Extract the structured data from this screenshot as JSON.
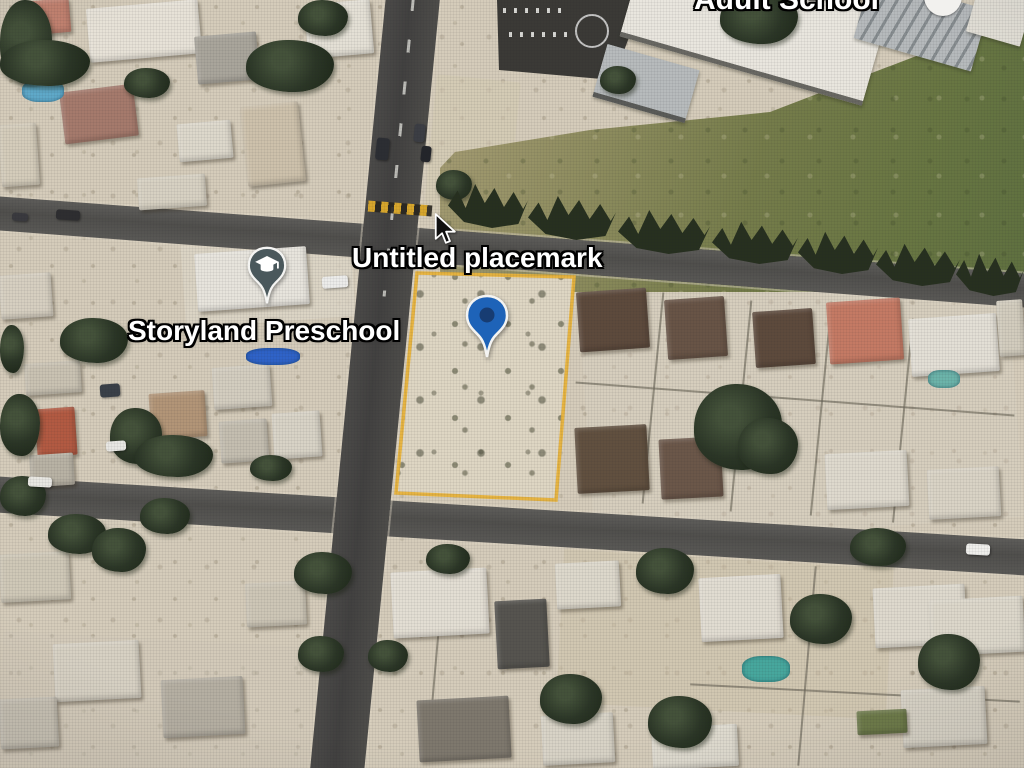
{
  "view": {
    "type": "satellite-aerial-map",
    "description": "Aerial imagery of a desert residential neighborhood with a highlighted vacant parcel"
  },
  "labels": {
    "placemark": "Untitled placemark",
    "preschool": "Storyland Preschool",
    "adult_school": "Adult School"
  },
  "markers": {
    "placemark_pin": {
      "icon": "map-pin",
      "x": 487,
      "y": 320
    },
    "preschool_pin": {
      "icon": "graduation-cap-pin",
      "x": 267,
      "y": 270
    },
    "adult_school_icon": {
      "icon": "white-circle",
      "x": 941,
      "y": 0
    }
  },
  "cursor": {
    "icon": "arrow-cursor",
    "x": 436,
    "y": 217
  },
  "parcel": {
    "points": "417,273 574,277 556,500 396,493",
    "outline_color": "#e7b23b"
  },
  "colors": {
    "pin_blue": "#1e63b8",
    "pin_blue_inner": "#173a6e",
    "pin_school": "#4a585c",
    "pin_outline": "#f4f4f2",
    "poi_circle": "#f2f1ee",
    "road": "#4c4b49",
    "sand": "#d5ccba",
    "grass": "#75804c",
    "tree": "#27301f",
    "crosswalk_yellow": "#d7a62c"
  },
  "scenery": {
    "zones": [
      [
        560,
        556,
        330,
        155,
        3,
        "#cdc1a7",
        0.5
      ],
      [
        183,
        238,
        170,
        84,
        -4,
        "#dcd5c5",
        0.85
      ],
      [
        430,
        78,
        84,
        142,
        5.6,
        "#d3c9b3",
        0.6
      ],
      [
        0,
        640,
        340,
        130,
        3,
        "#cfc8b8",
        0.4
      ],
      [
        586,
        282,
        430,
        250,
        -4,
        "#d9d2c2",
        0.35
      ]
    ],
    "buildings": [
      [
        628,
        -24,
        252,
        92,
        16,
        "#e9e6de",
        "edge"
      ],
      [
        598,
        56,
        96,
        50,
        16,
        "#b7bbbc",
        "edge"
      ],
      [
        860,
        -8,
        122,
        64,
        16,
        "",
        "stripes"
      ],
      [
        972,
        -12,
        56,
        52,
        16,
        "#e2dfd6",
        "plain"
      ]
    ],
    "houses": [
      [
        88,
        4,
        112,
        54,
        -5,
        "#e7e2d7"
      ],
      [
        20,
        0,
        50,
        34,
        -5,
        "#c28270"
      ],
      [
        62,
        88,
        74,
        52,
        -7,
        "#a57a6c"
      ],
      [
        196,
        34,
        62,
        48,
        -5,
        "#a9a59b"
      ],
      [
        306,
        2,
        66,
        54,
        -5,
        "#e4e0d5"
      ],
      [
        178,
        122,
        54,
        38,
        -5,
        "#ddd8cb"
      ],
      [
        244,
        104,
        58,
        80,
        -6,
        "#cdc1ab"
      ],
      [
        0,
        124,
        38,
        62,
        -4,
        "#d4ccba"
      ],
      [
        138,
        176,
        68,
        32,
        -4,
        "#d7d1c2"
      ],
      [
        196,
        250,
        112,
        58,
        -4,
        "#e7e4dc"
      ],
      [
        0,
        274,
        52,
        44,
        -4,
        "#d6cfc0"
      ],
      [
        25,
        362,
        56,
        32,
        -4,
        "#c9c2b2"
      ],
      [
        36,
        408,
        40,
        48,
        -4,
        "#b25a42"
      ],
      [
        150,
        392,
        56,
        46,
        -4,
        "#b29577"
      ],
      [
        213,
        366,
        58,
        42,
        -4,
        "#d3cdbf"
      ],
      [
        220,
        420,
        48,
        42,
        -4,
        "#c4beb0"
      ],
      [
        273,
        412,
        48,
        46,
        -4,
        "#d8d3c6"
      ],
      [
        30,
        454,
        44,
        32,
        -4,
        "#b8b2a4"
      ],
      [
        578,
        290,
        70,
        60,
        -4,
        "#5d4a3c"
      ],
      [
        666,
        298,
        60,
        60,
        -4,
        "#685446"
      ],
      [
        754,
        310,
        60,
        56,
        -4,
        "#5d4a3c"
      ],
      [
        828,
        300,
        74,
        62,
        -4,
        "#c47a64"
      ],
      [
        910,
        316,
        88,
        58,
        -4,
        "#e3dfd5"
      ],
      [
        576,
        426,
        72,
        66,
        -3,
        "#61503f"
      ],
      [
        660,
        438,
        62,
        60,
        -3,
        "#6b5749"
      ],
      [
        826,
        452,
        82,
        56,
        -3,
        "#ded9cd"
      ],
      [
        928,
        468,
        72,
        50,
        -3,
        "#d9d3c5"
      ],
      [
        998,
        300,
        26,
        56,
        -4,
        "#d2ccbd"
      ],
      [
        392,
        570,
        96,
        66,
        -3,
        "#e3ded3"
      ],
      [
        496,
        600,
        52,
        68,
        -3,
        "#56544f"
      ],
      [
        556,
        562,
        64,
        46,
        -3,
        "#ddd8cb"
      ],
      [
        700,
        576,
        82,
        64,
        -3,
        "#e1dcd1"
      ],
      [
        874,
        586,
        92,
        60,
        -3,
        "#ded9cd"
      ],
      [
        418,
        698,
        92,
        62,
        -3,
        "#7e786d"
      ],
      [
        542,
        714,
        72,
        50,
        -3,
        "#d8d3c6"
      ],
      [
        652,
        726,
        86,
        42,
        -3,
        "#dedace"
      ],
      [
        902,
        688,
        84,
        58,
        -3,
        "#d6d1c4"
      ],
      [
        0,
        553,
        70,
        48,
        -3,
        "#cfc8b7"
      ],
      [
        54,
        642,
        86,
        58,
        -3,
        "#d7d1c3"
      ],
      [
        162,
        678,
        82,
        58,
        -3,
        "#b5afa2"
      ],
      [
        246,
        582,
        60,
        44,
        -3,
        "#cdc6b6"
      ],
      [
        0,
        698,
        58,
        50,
        -3,
        "#c7c1b3"
      ],
      [
        930,
        598,
        94,
        56,
        -3,
        "#dcd7ca"
      ],
      [
        857,
        710,
        50,
        24,
        -3,
        "#6d7a49"
      ]
    ],
    "trees": [
      [
        0,
        0,
        52,
        84
      ],
      [
        246,
        40,
        88,
        52
      ],
      [
        298,
        0,
        50,
        36
      ],
      [
        124,
        68,
        46,
        30
      ],
      [
        0,
        40,
        90,
        46
      ],
      [
        60,
        318,
        68,
        45
      ],
      [
        0,
        325,
        24,
        48
      ],
      [
        110,
        408,
        52,
        56
      ],
      [
        135,
        435,
        78,
        42
      ],
      [
        0,
        394,
        40,
        62
      ],
      [
        436,
        170,
        36,
        30
      ],
      [
        600,
        66,
        36,
        28
      ],
      [
        720,
        -8,
        78,
        52
      ],
      [
        694,
        384,
        88,
        86
      ],
      [
        738,
        418,
        60,
        56
      ],
      [
        294,
        552,
        58,
        42
      ],
      [
        426,
        544,
        44,
        30
      ],
      [
        636,
        548,
        58,
        46
      ],
      [
        790,
        594,
        62,
        50
      ],
      [
        540,
        674,
        62,
        50
      ],
      [
        648,
        696,
        64,
        52
      ],
      [
        918,
        634,
        62,
        56
      ],
      [
        850,
        528,
        56,
        38
      ],
      [
        0,
        476,
        46,
        40
      ],
      [
        48,
        514,
        58,
        40
      ],
      [
        92,
        528,
        54,
        44
      ],
      [
        140,
        498,
        50,
        36
      ],
      [
        298,
        636,
        46,
        36
      ],
      [
        250,
        455,
        42,
        26
      ],
      [
        368,
        640,
        40,
        32
      ]
    ],
    "treerow": [
      [
        448,
        178,
        80,
        50
      ],
      [
        528,
        190,
        88,
        50
      ],
      [
        618,
        204,
        92,
        50
      ],
      [
        712,
        216,
        86,
        48
      ],
      [
        798,
        226,
        80,
        48
      ],
      [
        876,
        238,
        84,
        48
      ],
      [
        956,
        248,
        68,
        48
      ]
    ],
    "fences": [
      [
        652,
        292,
        2,
        212,
        5.6
      ],
      [
        740,
        300,
        2,
        212,
        5.6
      ],
      [
        820,
        306,
        2,
        210,
        5.6
      ],
      [
        902,
        318,
        2,
        205,
        5.6
      ],
      [
        575,
        398,
        440,
        2,
        4.3
      ],
      [
        435,
        560,
        2,
        200,
        5
      ],
      [
        806,
        566,
        2,
        200,
        5
      ],
      [
        690,
        692,
        330,
        2,
        3
      ]
    ],
    "pools": [
      [
        22,
        80,
        42,
        22,
        "#5fa9c9"
      ],
      [
        928,
        370,
        32,
        18,
        "#6cb4aa"
      ],
      [
        742,
        656,
        48,
        26,
        "#47a79d"
      ],
      [
        246,
        348,
        54,
        17,
        "#2f63c8"
      ]
    ],
    "cars": [
      [
        56,
        210,
        24,
        10,
        4,
        "#2e2e30"
      ],
      [
        12,
        213,
        16,
        8,
        4,
        "#3a3a3e"
      ],
      [
        414,
        124,
        11,
        18,
        6,
        "#3c3e44"
      ],
      [
        421,
        146,
        10,
        16,
        6,
        "#23252a"
      ],
      [
        376,
        138,
        13,
        22,
        6,
        "#2c2e33"
      ],
      [
        322,
        276,
        26,
        12,
        -4,
        "#ececea"
      ],
      [
        966,
        544,
        24,
        11,
        3,
        "#f0efec"
      ],
      [
        28,
        477,
        24,
        10,
        3,
        "#e8e7e2"
      ],
      [
        100,
        384,
        20,
        13,
        -4,
        "#3a4048"
      ],
      [
        106,
        441,
        20,
        10,
        -4,
        "#e8e7e3"
      ]
    ]
  }
}
